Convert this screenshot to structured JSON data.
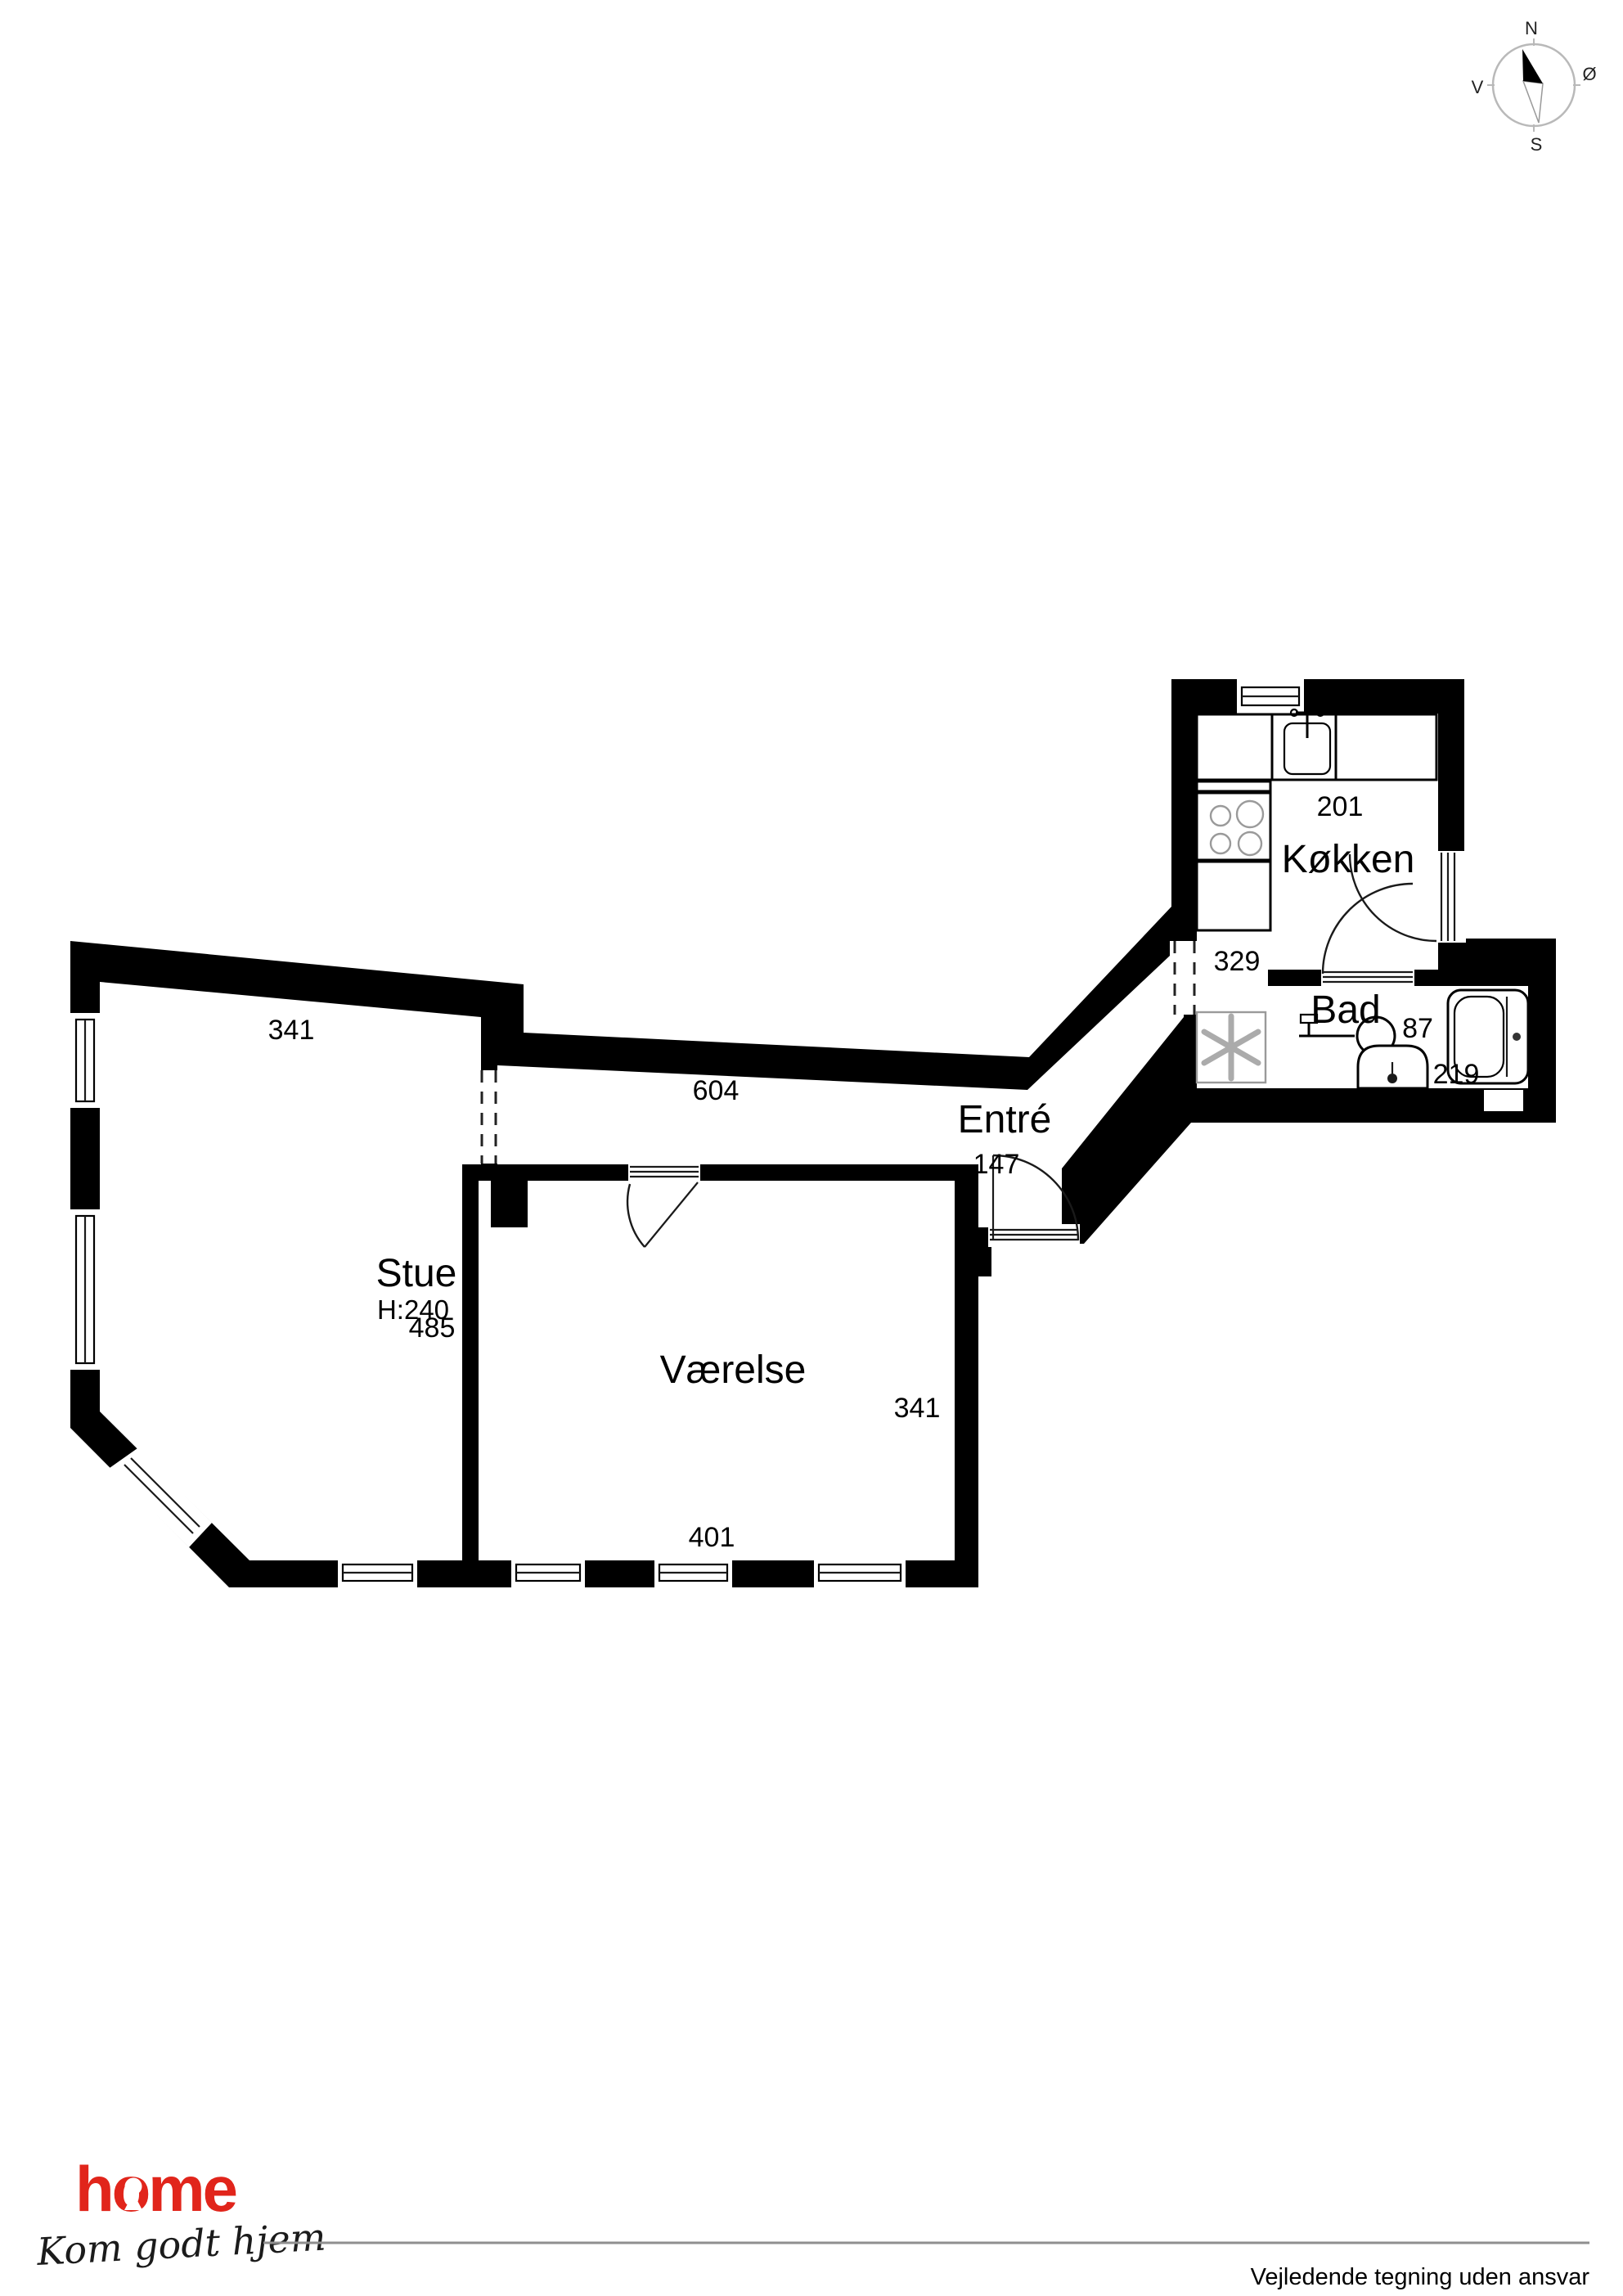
{
  "compass": {
    "north": "N",
    "east": "Ø",
    "south": "S",
    "west": "V"
  },
  "plan": {
    "wall_color": "#000000",
    "floor_color": "#ffffff",
    "rooms": {
      "stue": {
        "label": "Stue",
        "ceiling_height": "H:240",
        "dim_top": "341",
        "dim_right": "485"
      },
      "vaerelse": {
        "label": "Værelse",
        "dim_bottom": "401",
        "dim_right": "341"
      },
      "hall": {
        "dim_length": "604"
      },
      "entre": {
        "label": "Entré",
        "dim_entrance": "147"
      },
      "koekken": {
        "label": "Køkken",
        "dim_top": "201",
        "dim_left": "329"
      },
      "bad": {
        "label": "Bad",
        "dim_width": "87",
        "dim_length": "219"
      }
    }
  },
  "branding": {
    "logo_text": "home",
    "tagline": "Kom godt hjem",
    "brand_color": "#e1251b"
  },
  "footer": {
    "disclaimer": "Vejledende tegning uden ansvar"
  }
}
